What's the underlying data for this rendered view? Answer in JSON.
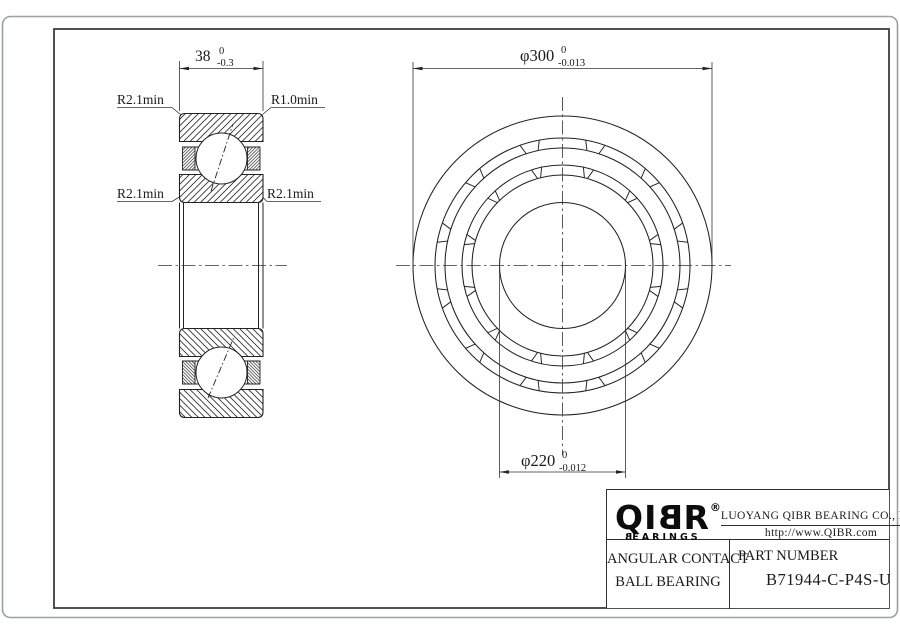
{
  "sheet": {
    "background": "#ffffff",
    "outer_border_color": "#9aa0a6",
    "frame_color": "#3d3d3d",
    "line_color": "#222222"
  },
  "section_view": {
    "dim_width": {
      "value": "38",
      "tol_upper": "0",
      "tol_lower": "-0.3"
    },
    "labels": {
      "top_left": "R2.1min",
      "top_right": "R1.0min",
      "bottom_left": "R2.1min",
      "bottom_right": "R2.1min"
    }
  },
  "front_view": {
    "dim_outer": {
      "value": "φ300",
      "tol_upper": "0",
      "tol_lower": "-0.013"
    },
    "dim_bore": {
      "value": "φ220",
      "tol_upper": "0",
      "tol_lower": "-0.012"
    }
  },
  "title_block": {
    "logo": {
      "brand": "QIBR",
      "registered": "®",
      "tagline": "BEARINGS"
    },
    "company": "LUOYANG QIBR BEARING CO., LTD",
    "website": "http://www.QIBR.com",
    "product_line1": "ANGULAR CONTACT",
    "product_line2": "BALL BEARING",
    "part_label": "PART NUMBER",
    "part_number": "B71944-C-P4S-U"
  }
}
